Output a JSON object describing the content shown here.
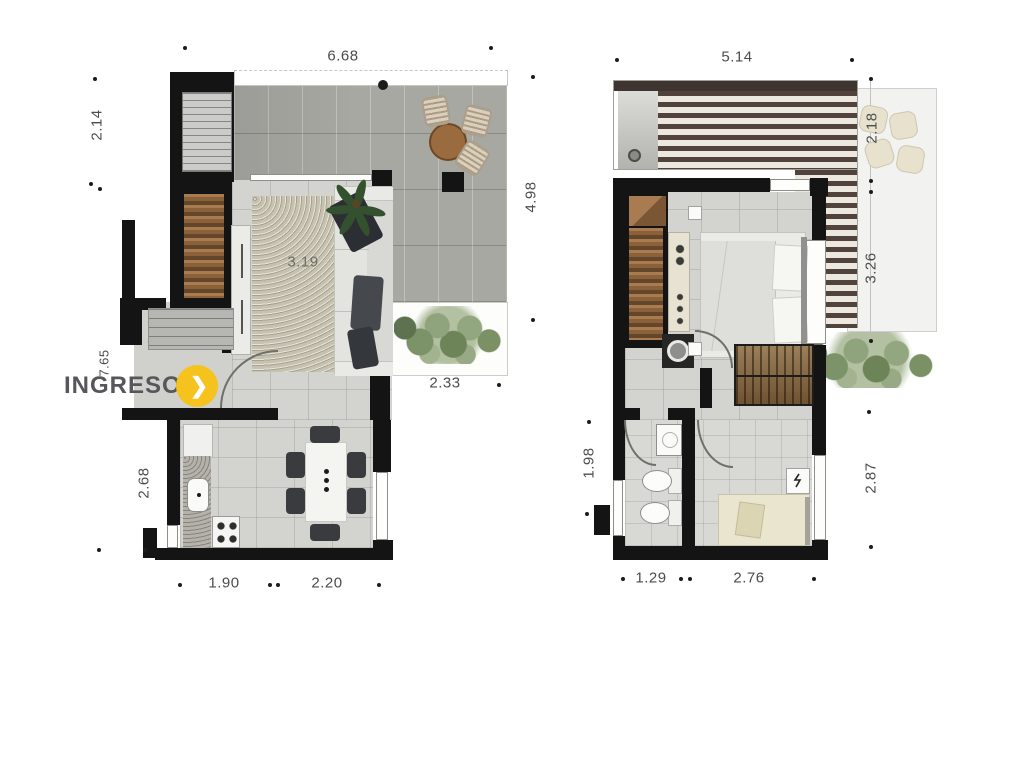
{
  "entrance": {
    "label": "INGRESO",
    "arrow_glyph": "❯"
  },
  "colors": {
    "accent_yellow": "#F6C31E",
    "wall_black": "#141414",
    "dim_text": "#4B4C4E"
  },
  "plans": {
    "left": {
      "name": "lower-floor-plan",
      "dims": {
        "top": "6.68",
        "upper_left": "2.14",
        "terrace_right": "4.98",
        "entry_left": "7.65",
        "living_rug": "3.19",
        "balcony": "2.33",
        "kitchen_left": "2.68",
        "bottom_left": "1.90",
        "bottom_right": "2.20"
      }
    },
    "right": {
      "name": "upper-floor-plan",
      "dims": {
        "top": "5.14",
        "terrace_upper_right": "2.18",
        "terrace_lower_right": "3.26",
        "bath_left": "1.98",
        "bedroom_right": "2.87",
        "bottom_left": "1.29",
        "bottom_right": "2.76"
      }
    }
  }
}
